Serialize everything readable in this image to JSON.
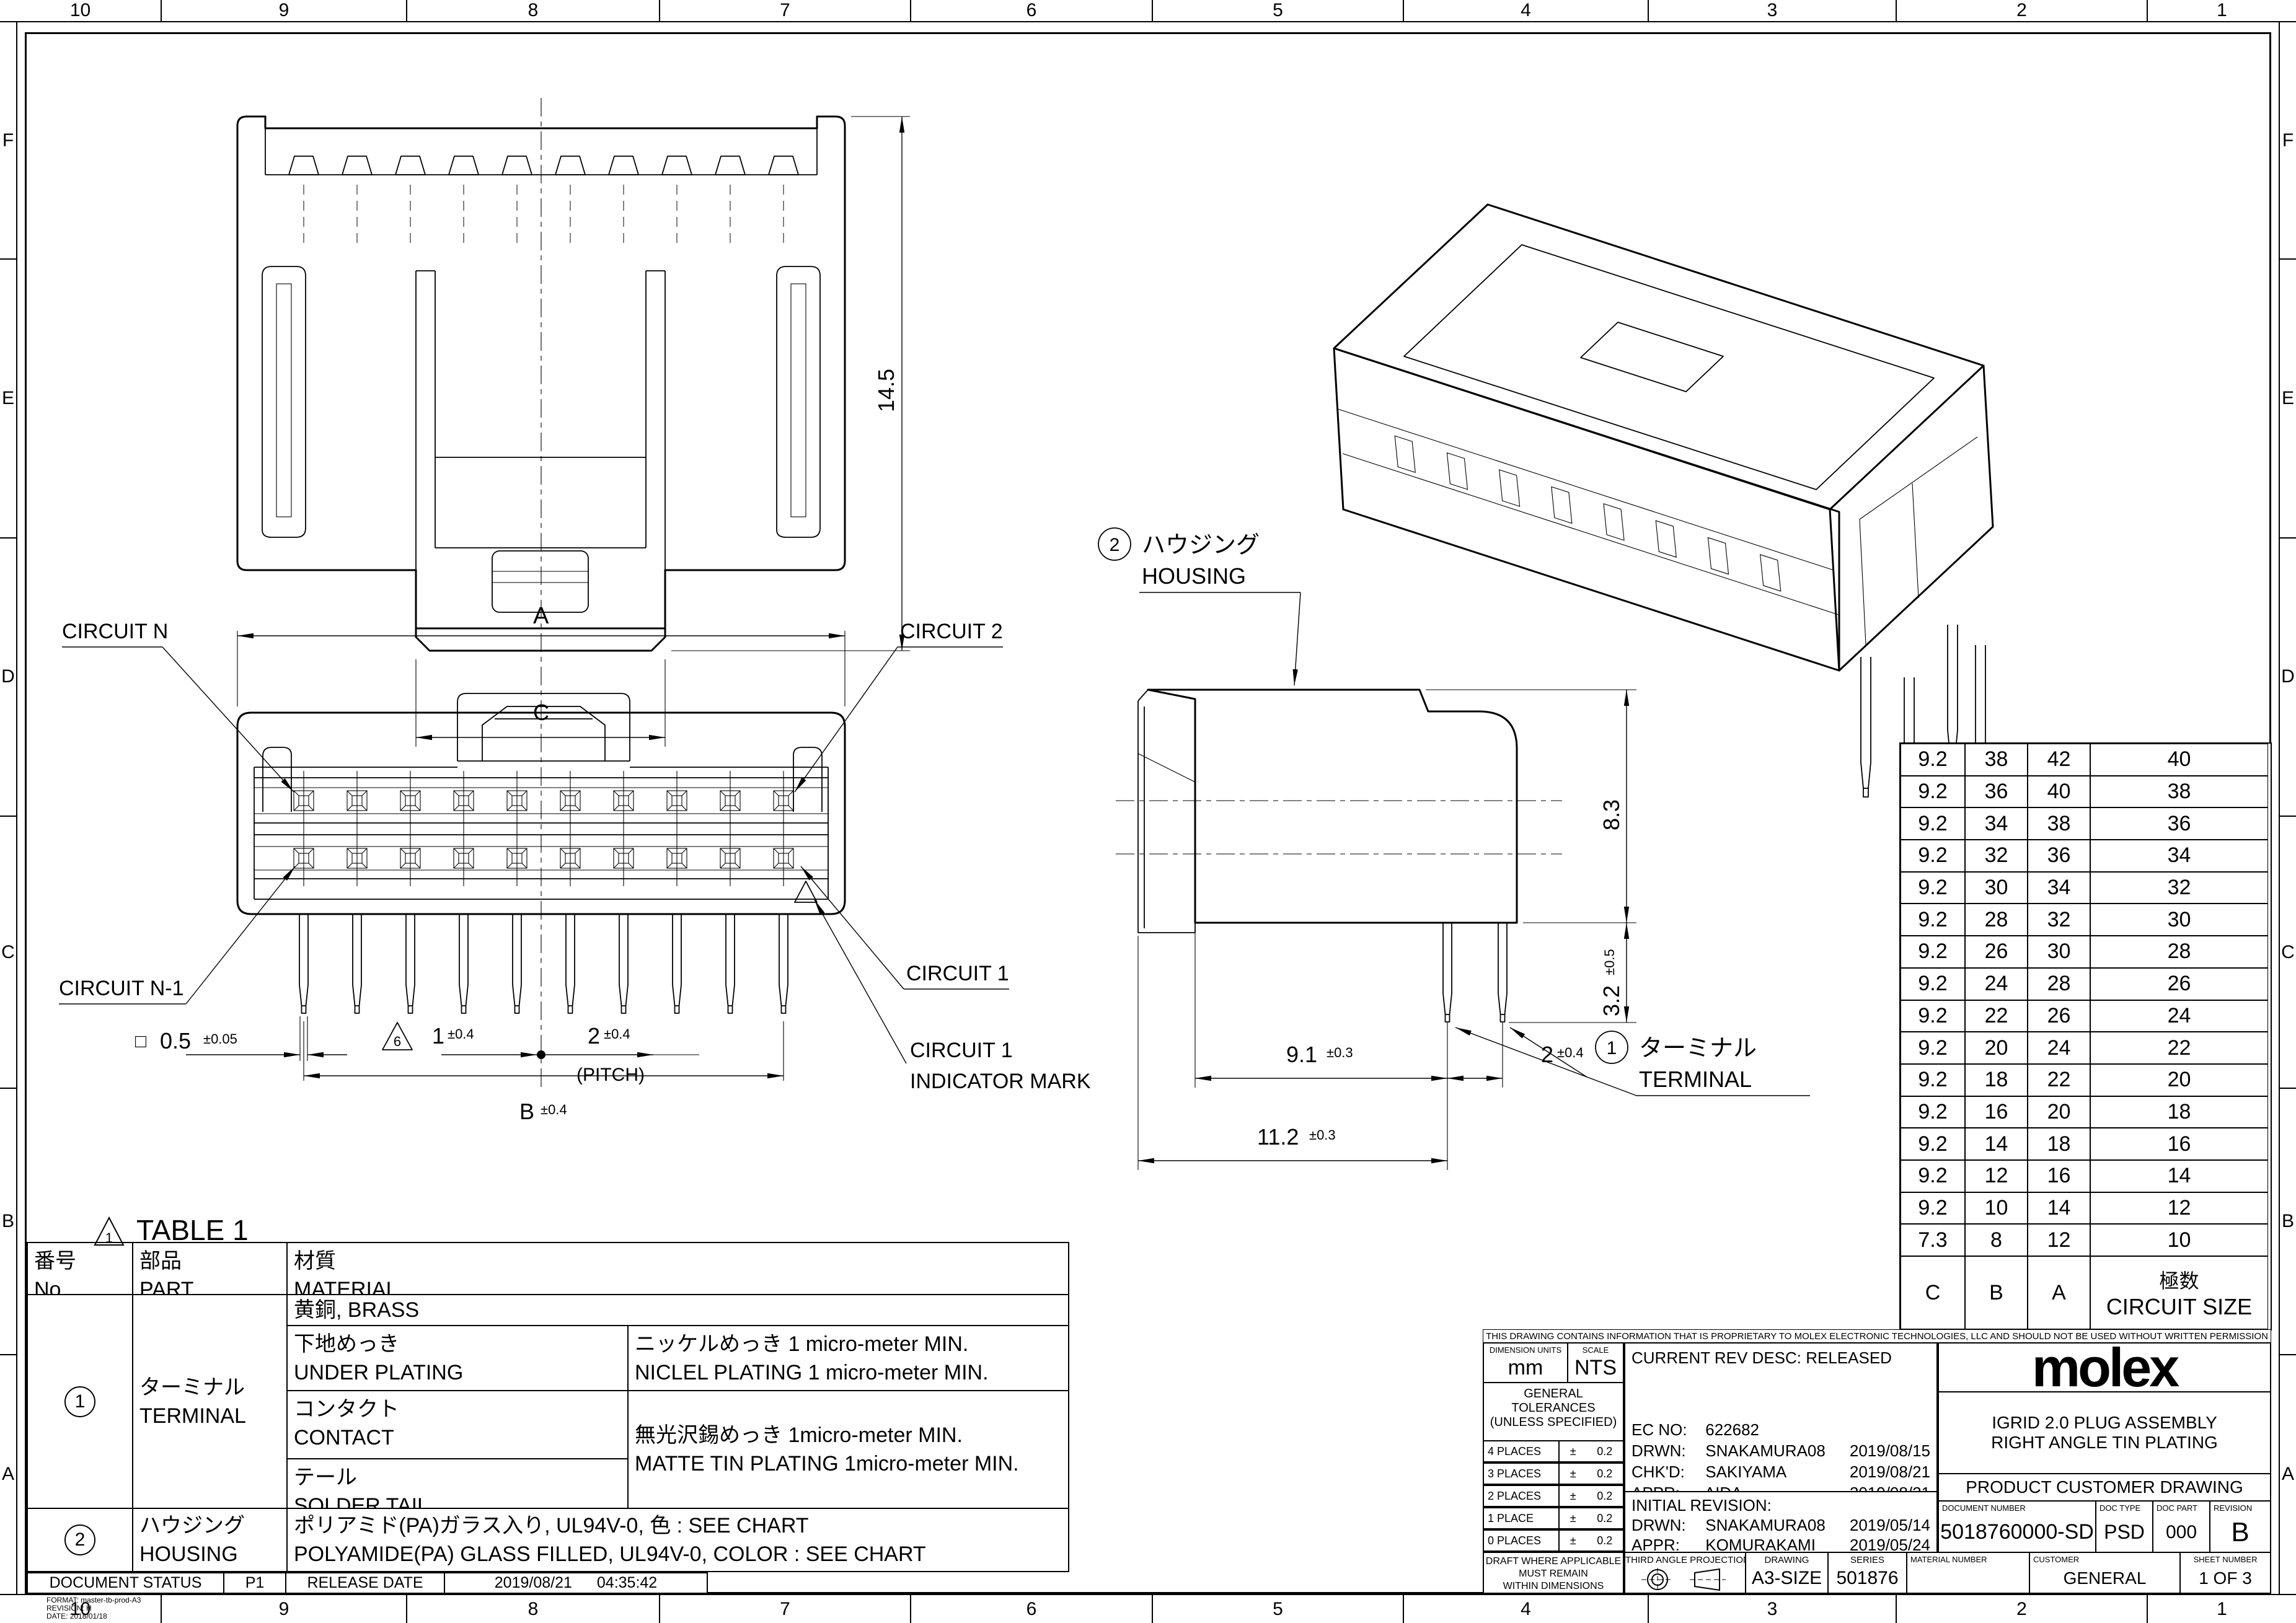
{
  "sheet": {
    "grid_cols": [
      "10",
      "9",
      "8",
      "7",
      "6",
      "5",
      "4",
      "3",
      "2",
      "1"
    ],
    "grid_rows": [
      "F",
      "E",
      "D",
      "C",
      "B",
      "A"
    ]
  },
  "views": {
    "front": {
      "height": "14.5",
      "width_label": "C"
    },
    "face": {
      "dim_a": "A",
      "dim_b": "B",
      "dim_b_tol": "±0.4",
      "circuit_n": "CIRCUIT N",
      "circuit_2": "CIRCUIT 2",
      "circuit_n1": "CIRCUIT N-1",
      "circuit_1": "CIRCUIT 1",
      "indicator_line1": "CIRCUIT 1",
      "indicator_line2": "INDICATOR MARK",
      "sq_sym": "□",
      "sq_val": "0.5",
      "sq_tol": "±0.05",
      "tri6": "6",
      "d1": "1",
      "d1_tol": "±0.4",
      "d2": "2",
      "d2_tol": "±0.4",
      "pitch": "(PITCH)"
    },
    "side": {
      "callout2": "2",
      "housing_jp": "ハウジング",
      "housing_en": "HOUSING",
      "callout1": "1",
      "terminal_jp": "ターミナル",
      "terminal_en": "TERMINAL",
      "h": "8.3",
      "pin": "3.2",
      "pin_tol": "±0.5",
      "d1": "9.1",
      "d1_tol": "±0.3",
      "d2": "11.2",
      "d2_tol": "±0.3",
      "p": "2",
      "p_tol": "±0.4"
    }
  },
  "circuit_table": {
    "rows": [
      [
        "9.2",
        "38",
        "42",
        "40"
      ],
      [
        "9.2",
        "36",
        "40",
        "38"
      ],
      [
        "9.2",
        "34",
        "38",
        "36"
      ],
      [
        "9.2",
        "32",
        "36",
        "34"
      ],
      [
        "9.2",
        "30",
        "34",
        "32"
      ],
      [
        "9.2",
        "28",
        "32",
        "30"
      ],
      [
        "9.2",
        "26",
        "30",
        "28"
      ],
      [
        "9.2",
        "24",
        "28",
        "26"
      ],
      [
        "9.2",
        "22",
        "26",
        "24"
      ],
      [
        "9.2",
        "20",
        "24",
        "22"
      ],
      [
        "9.2",
        "18",
        "22",
        "20"
      ],
      [
        "9.2",
        "16",
        "20",
        "18"
      ],
      [
        "9.2",
        "14",
        "18",
        "16"
      ],
      [
        "9.2",
        "12",
        "16",
        "14"
      ],
      [
        "9.2",
        "10",
        "14",
        "12"
      ],
      [
        "7.3",
        "8",
        "12",
        "10"
      ]
    ],
    "footer_c": "C",
    "footer_b": "B",
    "footer_a": "A",
    "footer_jp": "極数",
    "footer_en": "CIRCUIT SIZE"
  },
  "table1": {
    "title": "TABLE 1",
    "tri": "1",
    "h_no_jp": "番号",
    "h_no_en": "No.",
    "h_part_jp": "部品",
    "h_part_en": "PART",
    "h_mat_jp": "材質",
    "h_mat_en": "MATERIAL",
    "terminal_no": "1",
    "terminal_jp": "ターミナル",
    "terminal_en": "TERMINAL",
    "brass": "黄銅, BRASS",
    "under_jp": "下地めっき",
    "under_en": "UNDER PLATING",
    "nickel_jp": "ニッケルめっき 1 micro-meter MIN.",
    "nickel_en": "NICLEL PLATING 1 micro-meter  MIN.",
    "contact_jp": "コンタクト",
    "contact_en": "CONTACT",
    "tail_jp": "テール",
    "tail_en": "SOLDER TAIL",
    "tin_jp": "無光沢錫めっき 1micro-meter MIN.",
    "tin_en": "MATTE TIN PLATING 1micro-meter MIN.",
    "housing_no": "2",
    "housing_jp": "ハウジング",
    "housing_en": "HOUSING",
    "housing_mat_jp": "ポリアミド(PA)ガラス入り, UL94V-0, 色 : SEE CHART",
    "housing_mat_en": "POLYAMIDE(PA) GLASS FILLED, UL94V-0, COLOR : SEE CHART"
  },
  "title_block": {
    "notice": "THIS DRAWING CONTAINS INFORMATION THAT IS PROPRIETARY TO MOLEX ELECTRONIC TECHNOLOGIES, LLC AND SHOULD NOT BE USED WITHOUT WRITTEN PERMISSION",
    "dimension_units_label": "DIMENSION UNITS",
    "dimension_units": "mm",
    "scale_label": "SCALE",
    "scale": "NTS",
    "tol_title1": "GENERAL TOLERANCES",
    "tol_title2": "(UNLESS SPECIFIED)",
    "angular_label": "ANGULAR TOL",
    "angular_pm": "±",
    "angular_val": "3.0 °",
    "places": [
      {
        "label": "4 PLACES",
        "pm": "±",
        "val": "0.2"
      },
      {
        "label": "3 PLACES",
        "pm": "±",
        "val": "0.2"
      },
      {
        "label": "2 PLACES",
        "pm": "±",
        "val": "0.2"
      },
      {
        "label": "1 PLACE",
        "pm": "±",
        "val": "0.2"
      },
      {
        "label": "0 PLACES",
        "pm": "±",
        "val": "0.2"
      }
    ],
    "draft1": "DRAFT WHERE APPLICABLE",
    "draft2": "MUST REMAIN",
    "draft3": "WITHIN DIMENSIONS",
    "current_rev": "CURRENT REV DESC: RELEASED",
    "ec_label": "EC NO:",
    "ec": "622682",
    "drwn_label": "DRWN:",
    "drwn": "SNAKAMURA08",
    "drwn_date": "2019/08/15",
    "chkd_label": "CHK'D:",
    "chkd": "SAKIYAMA",
    "chkd_date": "2019/08/21",
    "appr_label": "APPR:",
    "appr": "AIDA",
    "appr_date": "2019/08/21",
    "initial_rev": "INITIAL REVISION:",
    "init_drwn_label": "DRWN:",
    "init_drwn": "SNAKAMURA08",
    "init_drwn_date": "2019/05/14",
    "init_appr_label": "APPR:",
    "init_appr": "KOMURAKAMI",
    "init_appr_date": "2019/05/24",
    "third_angle": "THIRD ANGLE PROJECTION",
    "drawing_label": "DRAWING",
    "drawing": "A3-SIZE",
    "series_label": "SERIES",
    "series": "501876",
    "logo": "molex",
    "product_line1": "IGRID 2.0 PLUG ASSEMBLY",
    "product_line2": "RIGHT ANGLE TIN PLATING",
    "doc_class": "PRODUCT CUSTOMER DRAWING",
    "doc_number_label": "DOCUMENT NUMBER",
    "doc_number": "5018760000-SD",
    "doc_type_label": "DOC TYPE",
    "doc_type": "PSD",
    "doc_part_label": "DOC PART",
    "doc_part": "000",
    "revision_label": "REVISION",
    "revision": "B",
    "material_number_label": "MATERIAL NUMBER",
    "customer_label": "CUSTOMER",
    "customer": "GENERAL",
    "sheet_label": "SHEET NUMBER",
    "sheet": "1 OF 3"
  },
  "status_bar": {
    "label": "DOCUMENT STATUS",
    "status": "P1",
    "release_label": "RELEASE DATE",
    "date": "2019/08/21",
    "time": "04:35:42"
  },
  "format_note": {
    "line1": "FORMAT: master-tb-prod-A3",
    "line2": "REVISION: H",
    "line3": "DATE: 2018/01/18"
  }
}
